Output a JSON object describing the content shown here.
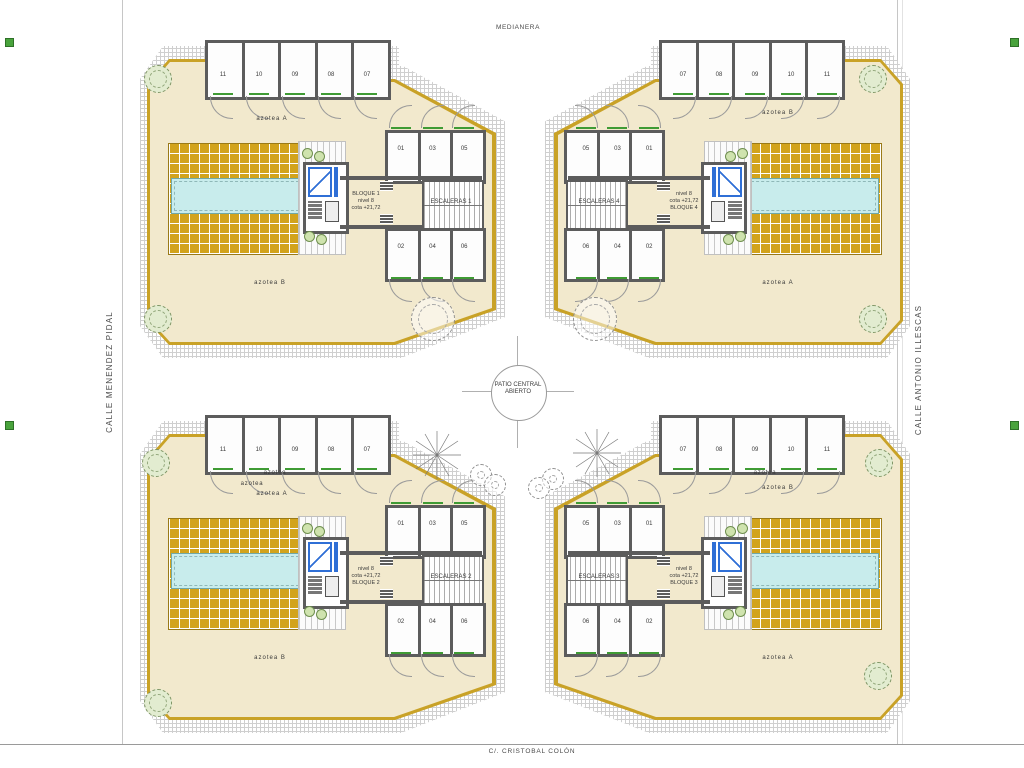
{
  "streets": {
    "top": "MEDIANERA",
    "left": "CALLE MENENDEZ PIDAL",
    "right": "CALLE ANTONIO ILLESCAS",
    "bottom": "C/. CRISTOBAL COLÓN"
  },
  "patio": {
    "line1": "PATIO CENTRAL",
    "line2": "ABIERTO"
  },
  "blocks": [
    {
      "id": "bloque-1",
      "variant": "left",
      "pos": "top-left",
      "storage": [
        "11",
        "10",
        "09",
        "08",
        "07"
      ],
      "rooms_top": [
        "01",
        "03",
        "05"
      ],
      "rooms_bottom": [
        "02",
        "04",
        "06"
      ],
      "core_lines": [
        "BLOQUE 1",
        "nivel 8",
        "cota +21,72"
      ],
      "stairs": "ESCALERAS 1",
      "azotea_top": "azotea A",
      "azotea_bottom": "azotea B",
      "azotea_small": []
    },
    {
      "id": "bloque-4",
      "variant": "right",
      "pos": "top-right",
      "storage": [
        "07",
        "08",
        "09",
        "10",
        "11"
      ],
      "rooms_top": [
        "05",
        "03",
        "01"
      ],
      "rooms_bottom": [
        "06",
        "04",
        "02"
      ],
      "core_lines": [
        "nivel 8",
        "cota +21,72",
        "BLOQUE 4"
      ],
      "stairs": "ESCALERAS 4",
      "azotea_top": "azotea B",
      "azotea_bottom": "azotea A",
      "azotea_small": []
    },
    {
      "id": "bloque-2",
      "variant": "left",
      "pos": "bottom-left",
      "storage": [
        "11",
        "10",
        "09",
        "08",
        "07"
      ],
      "rooms_top": [
        "01",
        "03",
        "05"
      ],
      "rooms_bottom": [
        "02",
        "04",
        "06"
      ],
      "core_lines": [
        "nivel 8",
        "cota +21,72",
        "BLOQUE 2"
      ],
      "stairs": "ESCALERAS 2",
      "azotea_top": "azotea A",
      "azotea_bottom": "azotea B",
      "azotea_small": [
        "azotea",
        "azotea"
      ]
    },
    {
      "id": "bloque-3",
      "variant": "right",
      "pos": "bottom-right",
      "storage": [
        "07",
        "08",
        "09",
        "10",
        "11"
      ],
      "rooms_top": [
        "05",
        "03",
        "01"
      ],
      "rooms_bottom": [
        "06",
        "04",
        "02"
      ],
      "core_lines": [
        "nivel 8",
        "cota +21,72",
        "BLOQUE 3"
      ],
      "stairs": "ESCALERAS 3",
      "azotea_top": "azotea B",
      "azotea_bottom": "azotea A",
      "azotea_small": [
        "azotea"
      ]
    }
  ],
  "colors": {
    "terrace": "#f2e9cd",
    "tiles": "#d2a31c",
    "trim": "#c9a227",
    "pool": "#c8ecec",
    "walls": "#5c5c5c",
    "elevator": "#2f6fd6",
    "green": "#3f9b34"
  }
}
